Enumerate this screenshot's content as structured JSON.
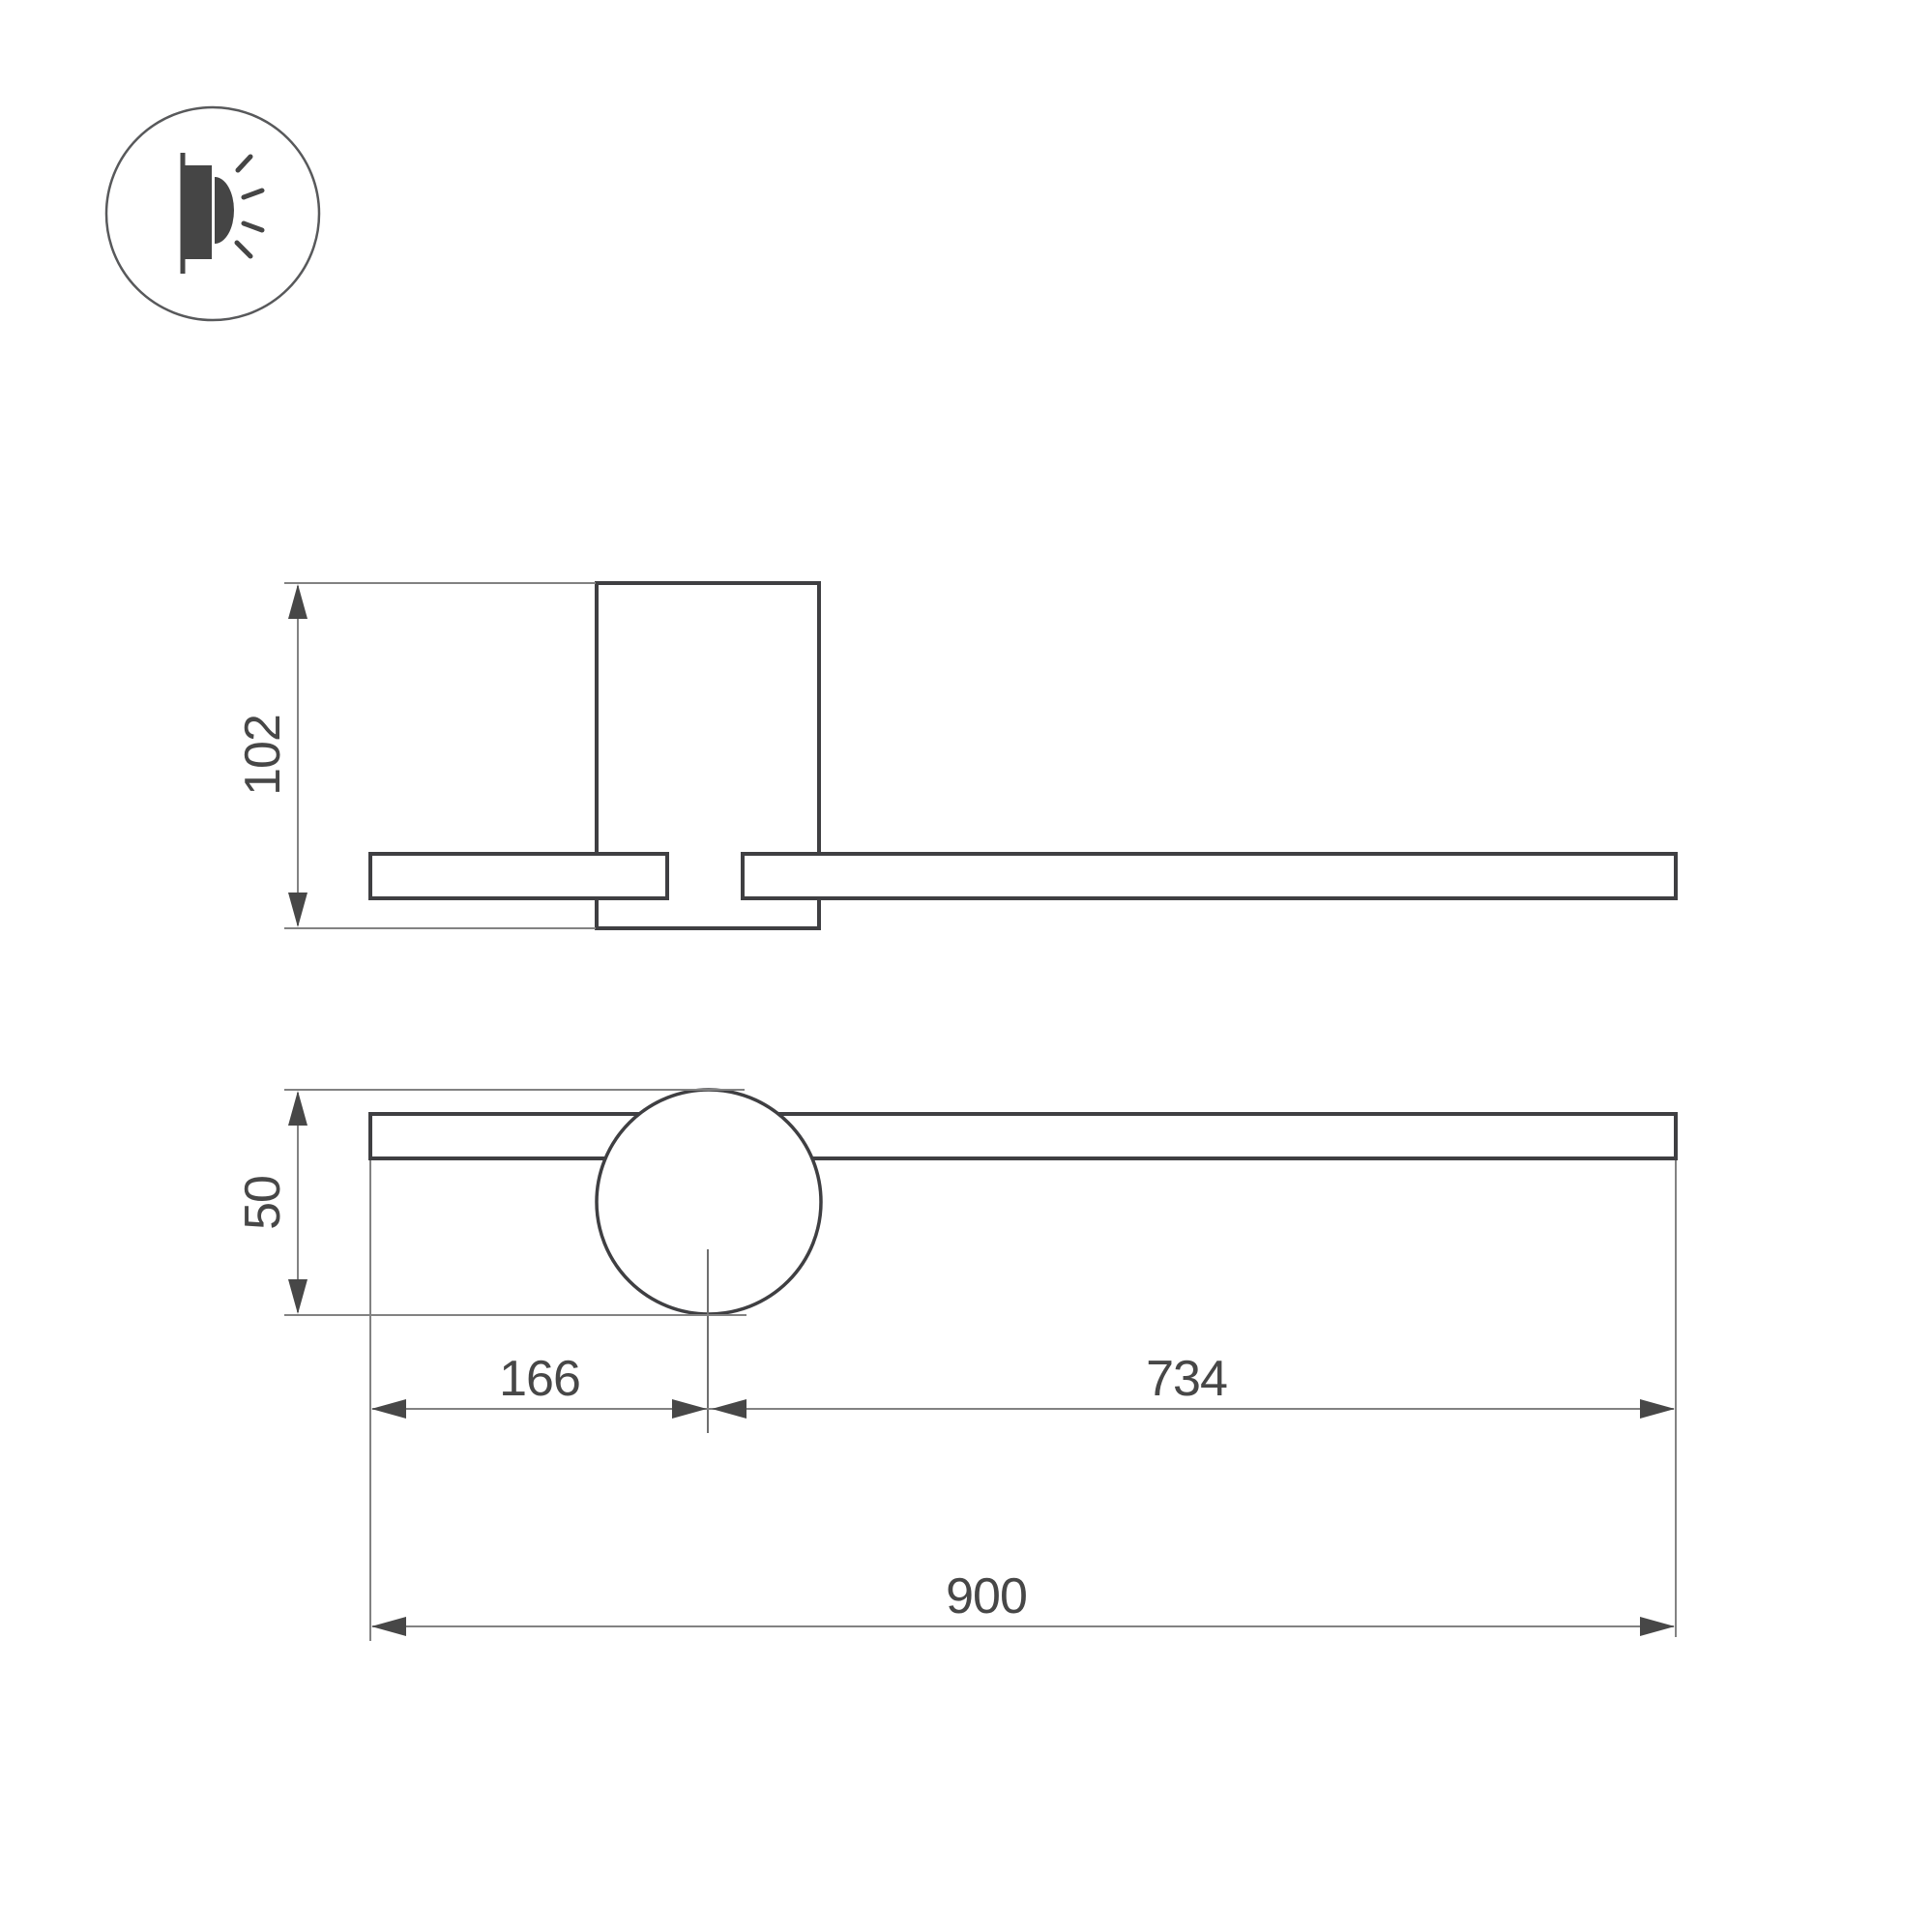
{
  "title": "Wall lamp technical dimension drawing",
  "icon": {
    "type": "wall-mounted-light-direction-badge"
  },
  "dimensions": {
    "side_height": "102",
    "lamp_diameter": "50",
    "center_from_left": "166",
    "center_to_right": "734",
    "total_length": "900"
  },
  "colors": {
    "outline_dark": "#3f3f42",
    "dimension_line": "#828282",
    "arrow_and_text": "#474747",
    "background": "#ffffff"
  }
}
